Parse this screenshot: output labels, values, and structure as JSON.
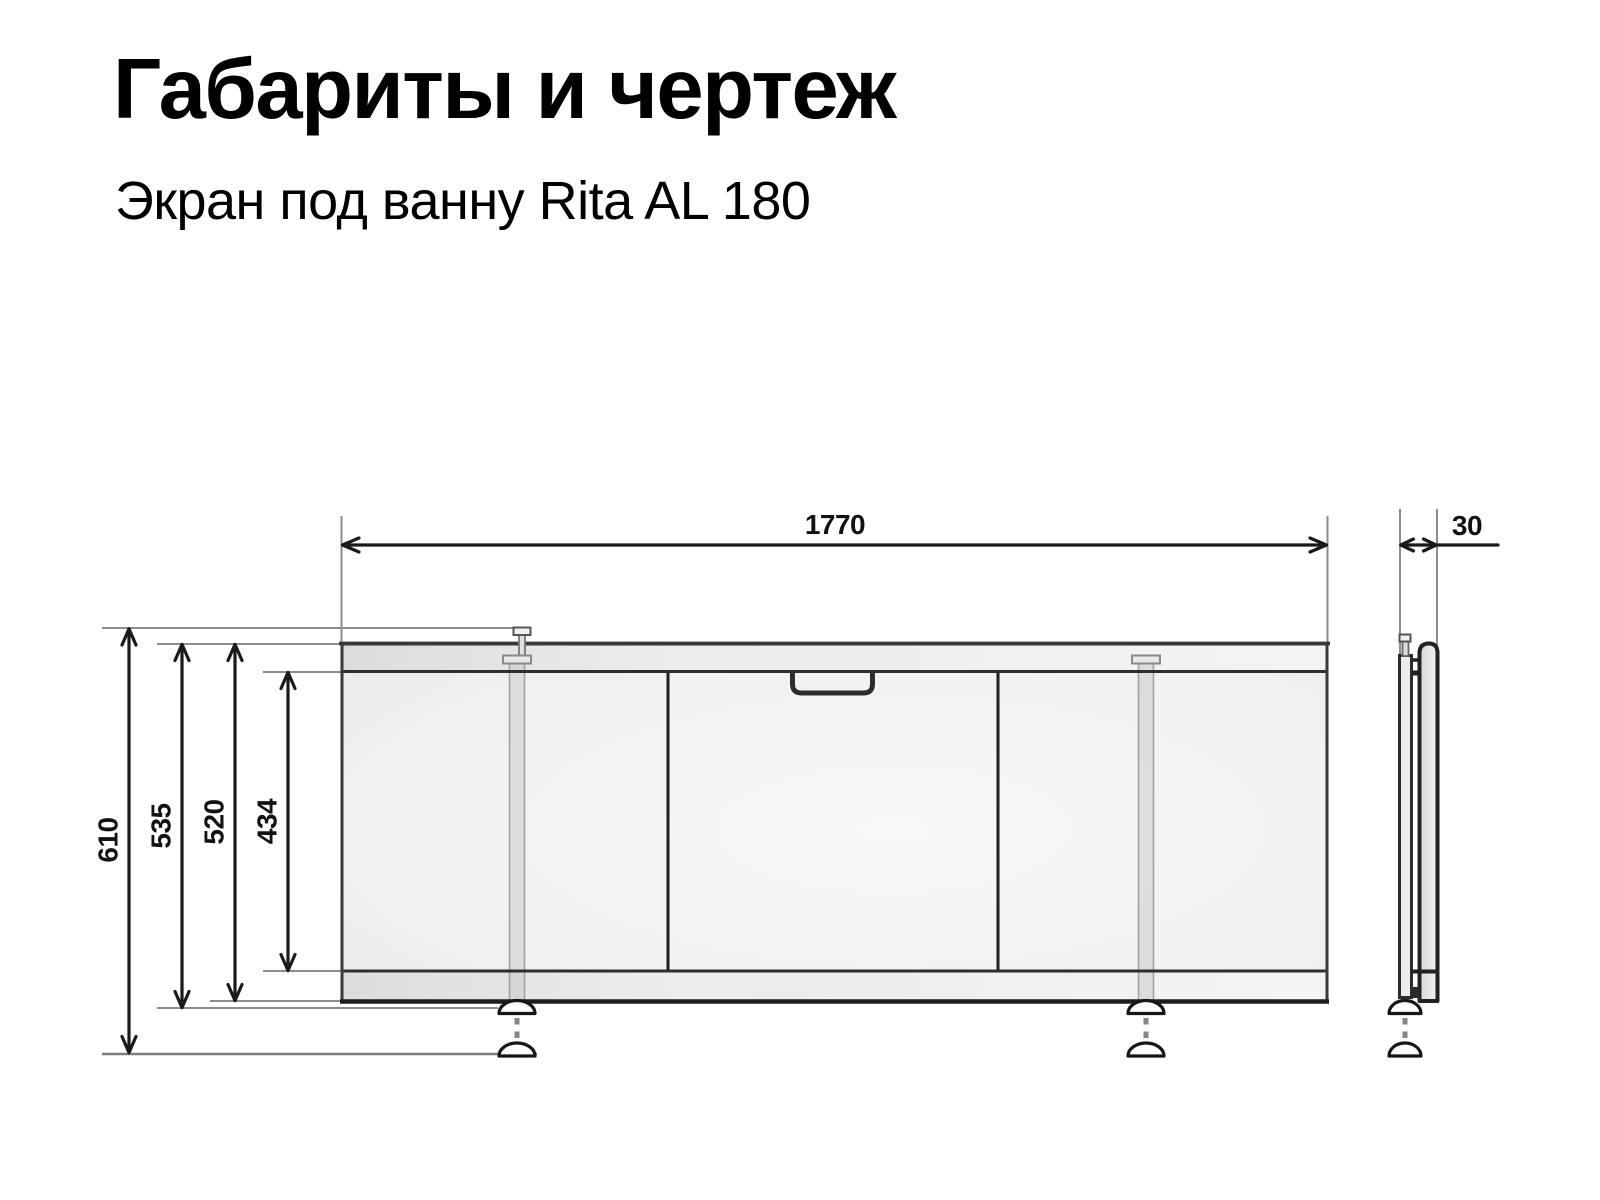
{
  "header": {
    "title": "Габариты и чертеж",
    "subtitle": "Экран под ванну Rita AL 180"
  },
  "drawing": {
    "product": "Экран под ванну Rita AL 180",
    "units": "mm",
    "front_view": {
      "width": {
        "label": "1770"
      },
      "heights": [
        {
          "name": "total-height-with-feet",
          "label": "610"
        },
        {
          "name": "height-to-foot-cap",
          "label": "535"
        },
        {
          "name": "frame-height",
          "label": "520"
        },
        {
          "name": "door-panel-height",
          "label": "434"
        }
      ],
      "panels": 3,
      "legs": 2
    },
    "side_view": {
      "depth": {
        "label": "30"
      }
    },
    "colors": {
      "outline": "#2e2e2e",
      "dimension_line": "#1a1a1a",
      "extension_line": "#8d8d8d",
      "rail_fill": "#e9e9e9",
      "face_fill": "#f1f1f1",
      "background": "#ffffff"
    }
  }
}
